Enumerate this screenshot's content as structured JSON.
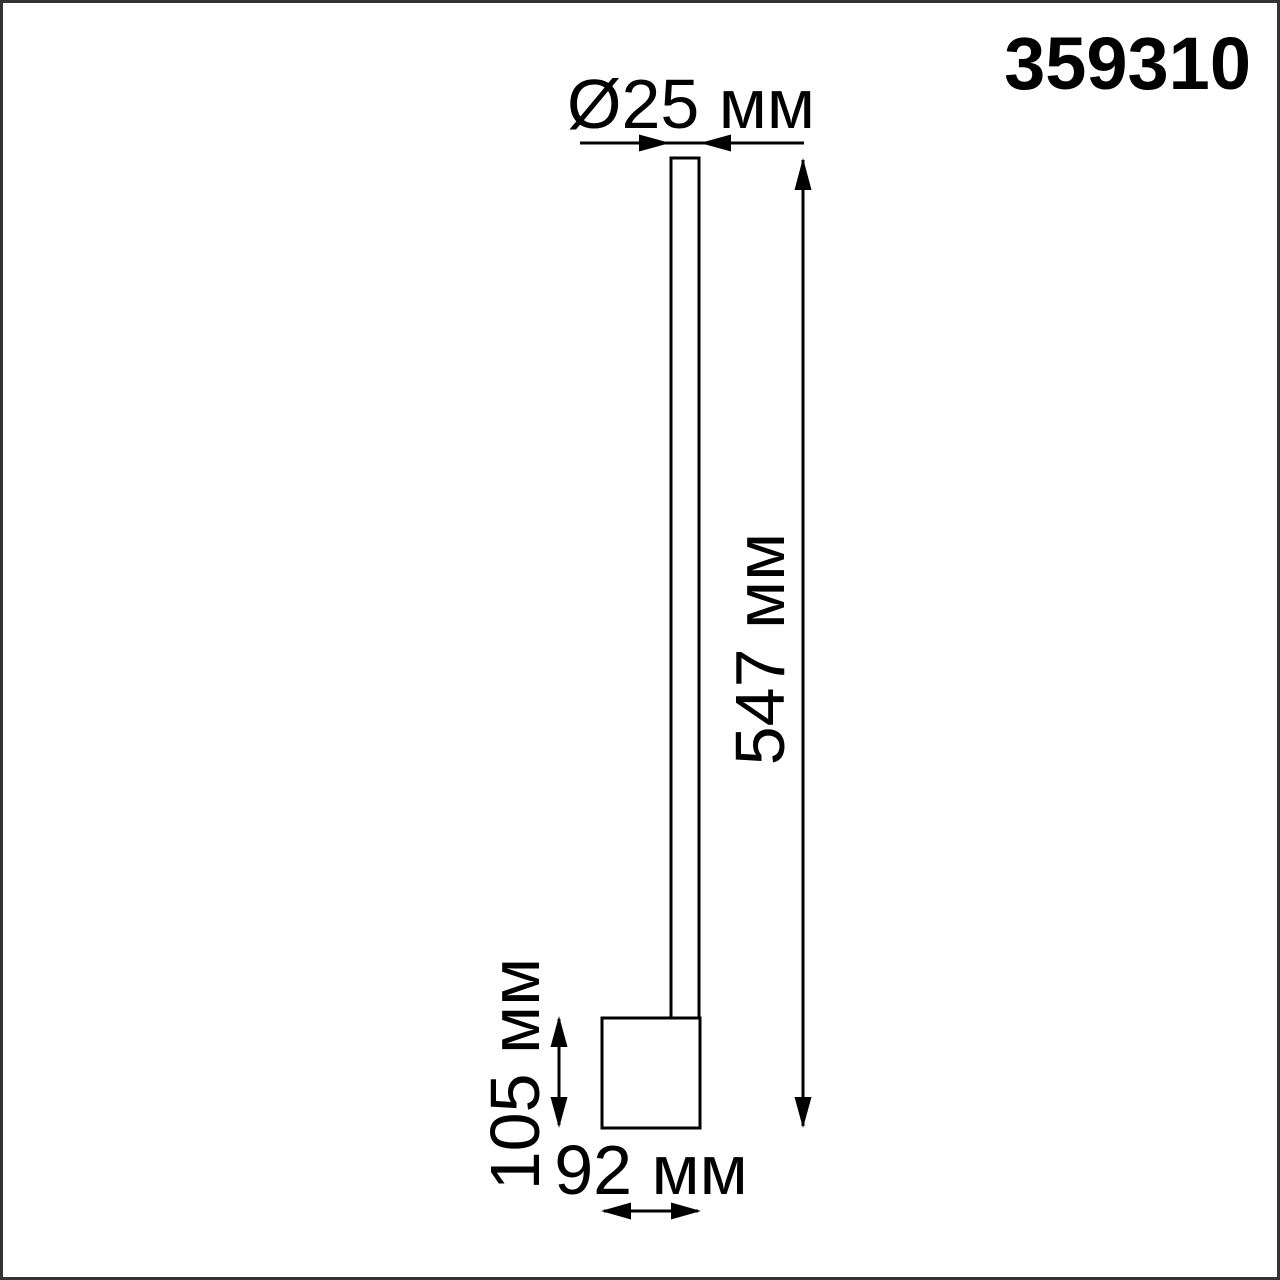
{
  "product_code": "359310",
  "dimensions": {
    "diameter": "Ø25 мм",
    "height": "547 мм",
    "base_height": "105 мм",
    "base_width": "92 мм"
  },
  "colors": {
    "ink": "#000000",
    "frame_border": "#333333",
    "background": "#ffffff"
  },
  "drawing": {
    "type": "technical-dimension-drawing",
    "subject": "wall-lamp-with-vertical-tube-and-base-box"
  }
}
